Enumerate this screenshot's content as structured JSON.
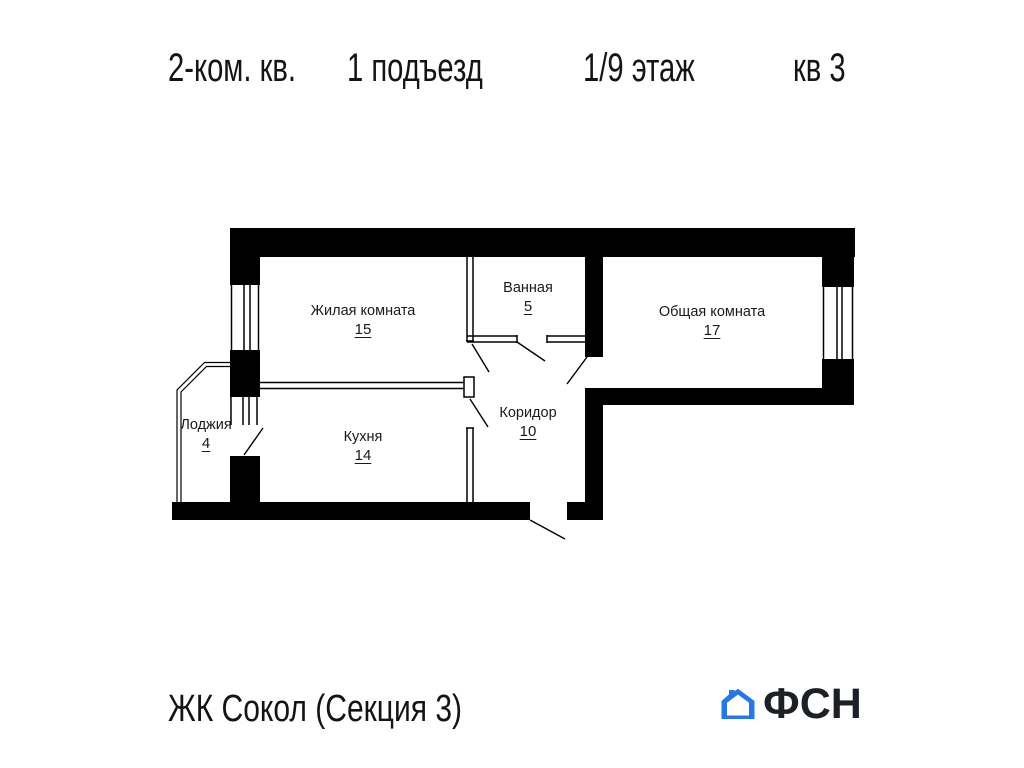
{
  "title": {
    "segments": [
      {
        "label": "2-ком. кв."
      },
      {
        "label": "1 подъезд"
      },
      {
        "label": "1/9 этаж"
      },
      {
        "label": "кв 3"
      }
    ]
  },
  "rooms": [
    {
      "name": "Жилая комната",
      "area": "15"
    },
    {
      "name": "Ванная",
      "area": "5"
    },
    {
      "name": "Общая комната",
      "area": "17"
    },
    {
      "name": "Коридор",
      "area": "10"
    },
    {
      "name": "Кухня",
      "area": "14"
    },
    {
      "name": "Лоджия",
      "area": "4"
    }
  ],
  "footer": {
    "project": "ЖК Сокол (Секция 3)",
    "logo_text": "ФСН"
  },
  "colors": {
    "walls": "#000000",
    "ink": "#1a1a1a",
    "logo_blue": "#2878e0",
    "logo_dark": "#1d2127"
  }
}
